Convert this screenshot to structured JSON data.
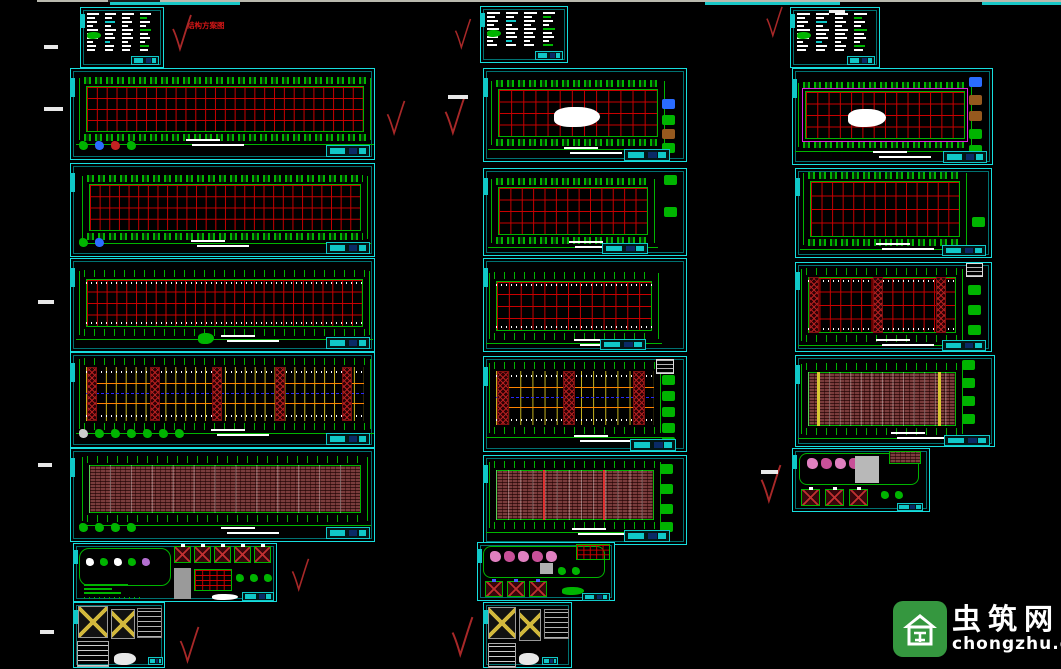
{
  "canvas": {
    "width": 1061,
    "height": 669,
    "background": "#000000"
  },
  "palette": {
    "sheet_border_cyan": "#17dede",
    "title_block_cyan": "#10c8c8",
    "grid_red": "#c80000",
    "structure_green": "#00b400",
    "bracing_yellow": "#c8b41e",
    "orange_line": "#ff8400",
    "blue_dashed": "#2828ff",
    "purlin_maroon": "#7a3c3c",
    "magenta_frame": "#e020e0",
    "check_red": "#a82828",
    "annotation_red": "#d31616",
    "logo_green": "#35973f"
  },
  "top_edge": {
    "line": {
      "x": 37,
      "y": 0,
      "w": 1024,
      "h": 2,
      "color": "#b9b9ae"
    },
    "dark_seg": {
      "x": 108,
      "y": 0,
      "w": 52,
      "h": 2,
      "color": "#1a1a1a"
    },
    "cyan_segs": [
      {
        "x": 110,
        "y": 2,
        "w": 130,
        "h": 3
      },
      {
        "x": 705,
        "y": 2,
        "w": 135,
        "h": 3
      },
      {
        "x": 982,
        "y": 2,
        "w": 79,
        "h": 3
      }
    ],
    "cyan": "#19c7c7"
  },
  "annotation": {
    "text": "结构方案图",
    "color": "#d31616"
  },
  "watermark": {
    "name": "虫筑网",
    "domain": "chongzhu.cn"
  },
  "checkmarks": [
    {
      "x": 170,
      "y": 14,
      "w": 24,
      "h": 38
    },
    {
      "x": 383,
      "y": 100,
      "w": 26,
      "h": 36
    },
    {
      "x": 440,
      "y": 96,
      "w": 30,
      "h": 40
    },
    {
      "x": 453,
      "y": 18,
      "w": 20,
      "h": 32
    },
    {
      "x": 763,
      "y": 6,
      "w": 23,
      "h": 32
    },
    {
      "x": 757,
      "y": 464,
      "w": 28,
      "h": 40
    },
    {
      "x": 289,
      "y": 558,
      "w": 23,
      "h": 34
    },
    {
      "x": 176,
      "y": 626,
      "w": 27,
      "h": 38
    },
    {
      "x": 449,
      "y": 616,
      "w": 27,
      "h": 42
    }
  ],
  "white_dashes": [
    {
      "x": 44,
      "y": 45,
      "w": 14,
      "h": 4
    },
    {
      "x": 44,
      "y": 107,
      "w": 19,
      "h": 4
    },
    {
      "x": 38,
      "y": 300,
      "w": 16,
      "h": 4
    },
    {
      "x": 38,
      "y": 463,
      "w": 14,
      "h": 4
    },
    {
      "x": 40,
      "y": 630,
      "w": 14,
      "h": 4
    },
    {
      "x": 448,
      "y": 95,
      "w": 20,
      "h": 4
    },
    {
      "x": 761,
      "y": 470,
      "w": 17,
      "h": 4
    }
  ],
  "sheets": [
    {
      "id": "drawing-sheet-l1-notes",
      "kind": "notes",
      "x": 80,
      "y": 7,
      "w": 84,
      "h": 61,
      "cols": 4
    },
    {
      "id": "drawing-sheet-l2-plan",
      "kind": "plan",
      "x": 70,
      "y": 68,
      "w": 305,
      "h": 92,
      "grid": {
        "l": 15,
        "t": 17,
        "w": 278,
        "h": 46
      },
      "cols": 28,
      "bands": "boxes",
      "legend": [
        "#00b400",
        "#2a6cff",
        "#c22222",
        "#00b400"
      ],
      "notebars": {
        "x": 115,
        "y": 70
      },
      "title": {
        "x": 255,
        "y": 76,
        "w": 44,
        "h": 12
      }
    },
    {
      "id": "drawing-sheet-l3-plan",
      "kind": "plan",
      "x": 70,
      "y": 163,
      "w": 305,
      "h": 94,
      "grid": {
        "l": 18,
        "t": 20,
        "w": 272,
        "h": 47
      },
      "cols": 28,
      "bands": "boxes",
      "legend": [
        "#00b400",
        "#2a6cff"
      ],
      "notebars": {
        "x": 120,
        "y": 76
      },
      "title": {
        "x": 255,
        "y": 78,
        "w": 44,
        "h": 12
      }
    },
    {
      "id": "drawing-sheet-l4-plan",
      "kind": "plan",
      "x": 70,
      "y": 258,
      "w": 305,
      "h": 94,
      "grid": {
        "l": 15,
        "t": 20,
        "w": 277,
        "h": 48
      },
      "cols": 28,
      "bands": "ticks",
      "dots": true,
      "cblob": [
        {
          "x": 127,
          "y": 74,
          "w": 16,
          "h": 11,
          "c": "#00b400"
        }
      ],
      "notebars": {
        "x": 150,
        "y": 76
      },
      "title": {
        "x": 255,
        "y": 78,
        "w": 44,
        "h": 12
      }
    },
    {
      "id": "drawing-sheet-l5-bracing",
      "kind": "brace",
      "x": 70,
      "y": 352,
      "w": 305,
      "h": 96,
      "grid": {
        "l": 15,
        "t": 14,
        "w": 278,
        "h": 54
      },
      "bays": 28,
      "xbands": [
        0.005,
        0.24,
        0.47,
        0.705,
        0.955
      ],
      "bw": 10,
      "legend": [
        "#cccccc",
        "#00b400",
        "#00b400",
        "#00b400",
        "#00b400",
        "#00b400",
        "#00b400"
      ],
      "notebars": {
        "x": 140,
        "y": 76
      },
      "title": {
        "x": 255,
        "y": 80,
        "w": 44,
        "h": 12
      }
    },
    {
      "id": "drawing-sheet-l6-purlins",
      "kind": "purlin",
      "x": 70,
      "y": 448,
      "w": 305,
      "h": 94,
      "grid": {
        "l": 18,
        "t": 16,
        "w": 272,
        "h": 48
      },
      "faint": 13,
      "marks": [],
      "legend": [
        "#00b400",
        "#00b400",
        "#00b400",
        "#00b400"
      ],
      "notebars": {
        "x": 150,
        "y": 78
      },
      "title": {
        "x": 255,
        "y": 78,
        "w": 44,
        "h": 12
      }
    },
    {
      "id": "drawing-sheet-l7-details",
      "kind": "details",
      "x": 73,
      "y": 543,
      "w": 204,
      "h": 59,
      "parts": [
        {
          "t": "rect",
          "x": 5,
          "y": 4,
          "w": 92,
          "h": 38,
          "bd": "#00b400",
          "br": 10
        },
        {
          "t": "icons",
          "x": 12,
          "y": 14,
          "colors": [
            "#ffffff",
            "#00b400",
            "#ffffff",
            "#00b400",
            "#b46fd0"
          ]
        },
        {
          "t": "bars",
          "x": 10,
          "y": 40,
          "w": 46,
          "n": 3,
          "c": "#00b400"
        },
        {
          "t": "dotrow",
          "x": 10,
          "y": 53,
          "w": 58,
          "c": "#00b400"
        },
        {
          "t": "xrow",
          "x": 100,
          "y": 2,
          "n": 5,
          "w": 17,
          "h": 17,
          "gap": 3,
          "bg": "#38060b",
          "bd": "#00b400",
          "lc": "#c03030",
          "tick": "#ffffff"
        },
        {
          "t": "rect",
          "x": 100,
          "y": 24,
          "w": 17,
          "h": 31,
          "bg": "#9a9a9a"
        },
        {
          "t": "grid",
          "x": 120,
          "y": 25,
          "w": 38,
          "h": 22,
          "cols": 5,
          "rows": 4
        },
        {
          "t": "icons",
          "x": 162,
          "y": 30,
          "colors": [
            "#00b400",
            "#00b400",
            "#00b400"
          ]
        },
        {
          "t": "blob",
          "x": 138,
          "y": 50,
          "w": 26,
          "h": 6,
          "bg": "#ffffff"
        },
        {
          "t": "title",
          "x": 168,
          "y": 48,
          "w": 32,
          "h": 9
        }
      ]
    },
    {
      "id": "drawing-sheet-l8-brace-details",
      "kind": "details",
      "x": 73,
      "y": 602,
      "w": 92,
      "h": 66,
      "parts": [
        {
          "t": "xpanel",
          "x": 4,
          "y": 3,
          "w": 30,
          "h": 32,
          "bg": "#111111",
          "bd": "#999999",
          "lc": "#d2b83c",
          "lw": 2
        },
        {
          "t": "xpanel",
          "x": 37,
          "y": 6,
          "w": 24,
          "h": 30,
          "bg": "#111111",
          "bd": "#999999",
          "lc": "#d2b83c",
          "lw": 2
        },
        {
          "t": "table",
          "x": 63,
          "y": 5,
          "w": 25,
          "h": 30,
          "bd": "#888888",
          "c": "rgba(255,255,255,.7)",
          "dots": true
        },
        {
          "t": "table",
          "x": 3,
          "y": 38,
          "w": 32,
          "h": 26,
          "bd": "#aaaaaa",
          "c": "rgba(255,255,255,.8)"
        },
        {
          "t": "blob",
          "x": 40,
          "y": 50,
          "w": 22,
          "h": 12,
          "bg": "#e8e8e8"
        },
        {
          "t": "title",
          "x": 74,
          "y": 54,
          "w": 15,
          "h": 8
        }
      ]
    },
    {
      "id": "drawing-sheet-m1-notes",
      "kind": "notes",
      "x": 480,
      "y": 6,
      "w": 88,
      "h": 57,
      "cols": 4
    },
    {
      "id": "drawing-sheet-m2-plan",
      "kind": "plan",
      "x": 483,
      "y": 68,
      "w": 204,
      "h": 94,
      "grid": {
        "l": 14,
        "t": 20,
        "w": 160,
        "h": 48
      },
      "cols": 13,
      "bands": "boxes",
      "cblob": [
        {
          "x": 70,
          "y": 38,
          "w": 46,
          "h": 20,
          "c": "#ffffff"
        }
      ],
      "rdet": {
        "x": 178,
        "ys": [
          30,
          46,
          60,
          74
        ],
        "colors": [
          "#2a6cff",
          "#00b400",
          "#96591e",
          "#00b400"
        ]
      },
      "notebars": {
        "x": 80,
        "y": 78
      },
      "title": {
        "x": 140,
        "y": 80,
        "w": 46,
        "h": 12
      }
    },
    {
      "id": "drawing-sheet-m3-plan",
      "kind": "plan",
      "x": 483,
      "y": 168,
      "w": 204,
      "h": 88,
      "grid": {
        "l": 14,
        "t": 18,
        "w": 150,
        "h": 48
      },
      "cols": 13,
      "bands": "boxes",
      "rdet": {
        "x": 180,
        "ys": [
          6,
          38
        ],
        "colors": [
          "#00b400",
          "#00b400"
        ]
      },
      "notebars": {
        "x": 85,
        "y": 72
      },
      "title": {
        "x": 118,
        "y": 74,
        "w": 46,
        "h": 11
      }
    },
    {
      "id": "drawing-sheet-m4-plan",
      "kind": "plan",
      "x": 483,
      "y": 258,
      "w": 204,
      "h": 94,
      "grid": {
        "l": 12,
        "t": 22,
        "w": 156,
        "h": 50
      },
      "cols": 13,
      "bands": "ticks",
      "dots": true,
      "notebars": {
        "x": 90,
        "y": 80
      },
      "title": {
        "x": 116,
        "y": 80,
        "w": 46,
        "h": 11
      }
    },
    {
      "id": "drawing-sheet-m5-bracing",
      "kind": "brace",
      "x": 483,
      "y": 356,
      "w": 204,
      "h": 96,
      "grid": {
        "l": 12,
        "t": 14,
        "w": 158,
        "h": 54
      },
      "bays": 13,
      "xbands": [
        0.005,
        0.46,
        0.94
      ],
      "bw": 12,
      "wbox": {
        "x": 172,
        "y": 2,
        "w": 18,
        "h": 15
      },
      "rdet": {
        "x": 178,
        "ys": [
          18,
          34,
          50,
          66,
          80
        ],
        "colors": [
          "#00b400",
          "#00b400",
          "#00b400",
          "#00b400",
          "#00b400"
        ]
      },
      "notebars": {
        "x": 90,
        "y": 78
      },
      "title": {
        "x": 146,
        "y": 82,
        "w": 46,
        "h": 12
      }
    },
    {
      "id": "drawing-sheet-m6-purlins",
      "kind": "purlin",
      "x": 483,
      "y": 455,
      "w": 204,
      "h": 90,
      "grid": {
        "l": 12,
        "t": 14,
        "w": 158,
        "h": 50
      },
      "faint": 13,
      "marks": [
        {
          "p": 0.3,
          "c": "#e03030",
          "w": 2
        },
        {
          "p": 0.68,
          "c": "#e03030",
          "w": 2
        }
      ],
      "rdet": {
        "x": 176,
        "ys": [
          8,
          28,
          48,
          66
        ],
        "colors": [
          "#00b400",
          "#00b400",
          "#00b400",
          "#00b400"
        ]
      },
      "notebars": {
        "x": 88,
        "y": 72
      },
      "title": {
        "x": 140,
        "y": 74,
        "w": 46,
        "h": 12
      }
    },
    {
      "id": "drawing-sheet-m7-details",
      "kind": "details",
      "x": 477,
      "y": 542,
      "w": 138,
      "h": 59,
      "parts": [
        {
          "t": "rect",
          "x": 5,
          "y": 3,
          "w": 122,
          "h": 32,
          "bd": "#00b400",
          "br": 8
        },
        {
          "t": "icons",
          "x": 12,
          "y": 8,
          "sz": 11,
          "gap": 3,
          "colors": [
            "#e080c0",
            "#c85098",
            "#e080c0",
            "#c85098",
            "#e080c0"
          ]
        },
        {
          "t": "grid",
          "x": 98,
          "y": 1,
          "w": 34,
          "h": 16,
          "cols": 5,
          "rows": 3
        },
        {
          "t": "rect",
          "x": 62,
          "y": 20,
          "w": 13,
          "h": 11,
          "bg": "#b0b0b0"
        },
        {
          "t": "icons",
          "x": 80,
          "y": 24,
          "colors": [
            "#00b400",
            "#00b400"
          ]
        },
        {
          "t": "xrow",
          "x": 7,
          "y": 38,
          "n": 3,
          "w": 18,
          "h": 16,
          "gap": 4,
          "bg": "#38060b",
          "bd": "#00b400",
          "lc": "#c03030",
          "tick": "#4060ff"
        },
        {
          "t": "blob",
          "x": 84,
          "y": 44,
          "w": 22,
          "h": 8,
          "bg": "#00b400"
        },
        {
          "t": "title",
          "x": 104,
          "y": 50,
          "w": 28,
          "h": 8
        }
      ]
    },
    {
      "id": "drawing-sheet-m8-brace-details",
      "kind": "details",
      "x": 483,
      "y": 602,
      "w": 89,
      "h": 66,
      "parts": [
        {
          "t": "xpanel",
          "x": 4,
          "y": 4,
          "w": 28,
          "h": 32,
          "bg": "#111111",
          "bd": "#999999",
          "lc": "#d2b83c",
          "lw": 2
        },
        {
          "t": "xpanel",
          "x": 35,
          "y": 6,
          "w": 22,
          "h": 32,
          "bg": "#111111",
          "bd": "#999999",
          "lc": "#d2b83c",
          "lw": 2
        },
        {
          "t": "table",
          "x": 60,
          "y": 6,
          "w": 25,
          "h": 30,
          "bd": "#888888",
          "c": "rgba(255,255,255,.7)",
          "dots": true
        },
        {
          "t": "table",
          "x": 4,
          "y": 40,
          "w": 28,
          "h": 25,
          "bd": "#aaaaaa",
          "c": "rgba(255,255,255,.8)"
        },
        {
          "t": "blob",
          "x": 35,
          "y": 50,
          "w": 20,
          "h": 12,
          "bg": "#e8e8e8"
        },
        {
          "t": "title",
          "x": 58,
          "y": 54,
          "w": 16,
          "h": 8
        }
      ]
    },
    {
      "id": "drawing-sheet-r1-notes",
      "kind": "notes",
      "x": 790,
      "y": 7,
      "w": 90,
      "h": 61,
      "cols": 4,
      "toplabel": true
    },
    {
      "id": "drawing-sheet-r2-plan",
      "kind": "plan",
      "x": 792,
      "y": 68,
      "w": 201,
      "h": 97,
      "grid": {
        "l": 12,
        "t": 22,
        "w": 160,
        "h": 48
      },
      "cols": 14,
      "bands": "boxes",
      "magenta": true,
      "cblob": [
        {
          "x": 55,
          "y": 40,
          "w": 38,
          "h": 18,
          "c": "#ffffff"
        }
      ],
      "rdet": {
        "x": 176,
        "ys": [
          8,
          26,
          42,
          60,
          76
        ],
        "colors": [
          "#2a6cff",
          "#96591e",
          "#96591e",
          "#00b400",
          "#00b400"
        ]
      },
      "notebars": {
        "x": 80,
        "y": 82
      },
      "title": {
        "x": 150,
        "y": 82,
        "w": 44,
        "h": 12
      }
    },
    {
      "id": "drawing-sheet-r3-plan",
      "kind": "plan",
      "x": 795,
      "y": 168,
      "w": 197,
      "h": 90,
      "grid": {
        "l": 14,
        "t": 12,
        "w": 150,
        "h": 56
      },
      "cols": 14,
      "bands": "boxes",
      "rdet": {
        "x": 176,
        "ys": [
          48
        ],
        "colors": [
          "#00b400"
        ]
      },
      "notebars": {
        "x": 80,
        "y": 74
      },
      "title": {
        "x": 146,
        "y": 76,
        "w": 44,
        "h": 11
      }
    },
    {
      "id": "drawing-sheet-r4-plan",
      "kind": "plan",
      "x": 795,
      "y": 262,
      "w": 197,
      "h": 90,
      "grid": {
        "l": 12,
        "t": 14,
        "w": 148,
        "h": 56
      },
      "cols": 14,
      "bands": "ticks",
      "dots": true,
      "xbands": [
        0.005,
        0.47,
        0.93
      ],
      "bw": 10,
      "wbox": {
        "x": 170,
        "y": 0,
        "w": 17,
        "h": 14
      },
      "rdet": {
        "x": 172,
        "ys": [
          22,
          42,
          62
        ],
        "colors": [
          "#00b400",
          "#00b400",
          "#00b400"
        ]
      },
      "notebars": {
        "x": 80,
        "y": 76
      },
      "title": {
        "x": 146,
        "y": 77,
        "w": 44,
        "h": 11
      }
    },
    {
      "id": "drawing-sheet-r5-purlins",
      "kind": "purlin",
      "x": 795,
      "y": 355,
      "w": 200,
      "h": 92,
      "grid": {
        "l": 12,
        "t": 16,
        "w": 148,
        "h": 54
      },
      "faint": 14,
      "marks": [
        {
          "p": 0.06,
          "c": "#d8c832",
          "w": 3
        },
        {
          "p": 0.88,
          "c": "#d8c832",
          "w": 3
        }
      ],
      "rdet": {
        "x": 166,
        "ys": [
          4,
          22,
          40,
          58
        ],
        "colors": [
          "#00b400",
          "#00b400",
          "#00b400",
          "#00b400"
        ]
      },
      "notebars": {
        "x": 95,
        "y": 76
      },
      "title": {
        "x": 148,
        "y": 79,
        "w": 46,
        "h": 11
      }
    },
    {
      "id": "drawing-sheet-r6-details",
      "kind": "details",
      "x": 792,
      "y": 448,
      "w": 138,
      "h": 64,
      "parts": [
        {
          "t": "rect",
          "x": 6,
          "y": 4,
          "w": 120,
          "h": 32,
          "bd": "#00b400",
          "br": 8
        },
        {
          "t": "icons",
          "x": 14,
          "y": 9,
          "sz": 11,
          "gap": 3,
          "colors": [
            "#e080c0",
            "#c85098",
            "#e080c0",
            "#c85098"
          ]
        },
        {
          "t": "rect",
          "x": 62,
          "y": 7,
          "w": 24,
          "h": 27,
          "bg": "#b8b8b8"
        },
        {
          "t": "hatchrect",
          "x": 96,
          "y": 2,
          "w": 32,
          "h": 13
        },
        {
          "t": "xrow",
          "x": 8,
          "y": 40,
          "n": 3,
          "w": 19,
          "h": 17,
          "gap": 5,
          "bg": "#38060b",
          "bd": "#00b400",
          "lc": "#c03030",
          "tick": "#ffffff"
        },
        {
          "t": "icons",
          "x": 88,
          "y": 42,
          "colors": [
            "#00b400",
            "#00b400"
          ]
        },
        {
          "t": "title",
          "x": 104,
          "y": 54,
          "w": 26,
          "h": 8
        }
      ]
    }
  ]
}
